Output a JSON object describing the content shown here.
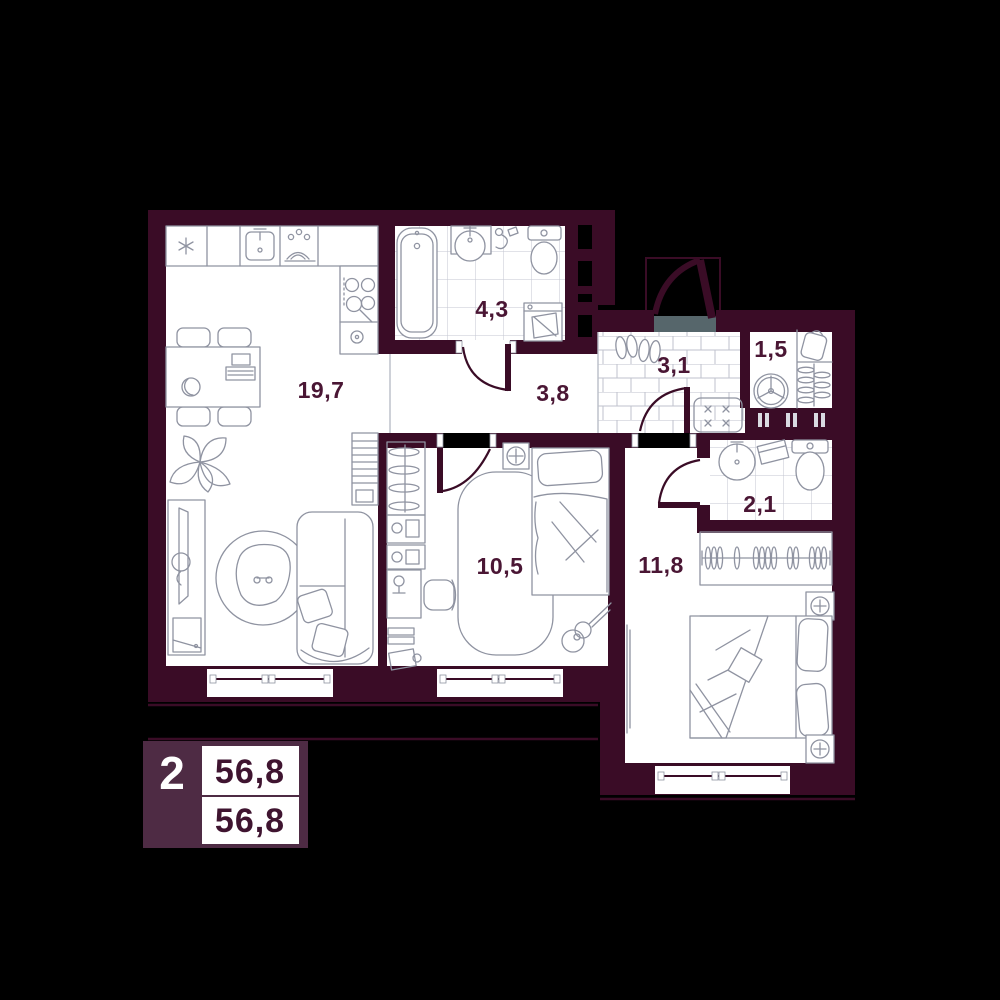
{
  "plan": {
    "rooms": [
      {
        "id": "kitchen-living",
        "area": "19,7"
      },
      {
        "id": "bathroom",
        "area": "4,3"
      },
      {
        "id": "hallway",
        "area": "3,8"
      },
      {
        "id": "entry-hall",
        "area": "3,1"
      },
      {
        "id": "storage",
        "area": "1,5"
      },
      {
        "id": "bedroom-small",
        "area": "10,5"
      },
      {
        "id": "wc",
        "area": "2,1"
      },
      {
        "id": "bedroom-large",
        "area": "11,8"
      }
    ]
  },
  "legend": {
    "rooms_count": "2",
    "total_area": "56,8",
    "living_area": "56,8"
  },
  "colors": {
    "background": "#000000",
    "wall": "#3a0c26",
    "room_fill": "#ffffff",
    "legend_box": "#4e2b44",
    "label_text": "#4a1634",
    "furniture_line": "#8f93a1",
    "tile_line": "#c3c6d0",
    "entry_threshold": "#56666b"
  },
  "icons": [
    "fridge-icon",
    "kitchen-sink-icon",
    "dish-rack-icon",
    "stove-icon",
    "kettle-icon",
    "dining-table-icon",
    "chair-icon",
    "laptop-icon",
    "plate-icon",
    "plant-icon",
    "tv-stand-icon",
    "round-rug-icon",
    "armchair-icon",
    "sofa-icon",
    "bookshelf-icon",
    "bathtub-icon",
    "washbasin-icon",
    "hand-shower-icon",
    "toilet-icon",
    "washing-machine-icon",
    "shoes-icon",
    "doormat-icon",
    "ventilation-fan-icon",
    "bag-shelf-icon",
    "coat-rack-icon",
    "hanger-rail-icon",
    "ceiling-light-icon",
    "rug-icon",
    "single-bed-icon",
    "guitar-icon",
    "desk-icon",
    "desk-chair-icon",
    "wardrobe-icon",
    "double-bed-icon",
    "nightstand-lamp-icon",
    "mirror-icon",
    "entry-door-icon",
    "interior-door-icon",
    "window-icon",
    "ventilation-shaft-icon"
  ]
}
